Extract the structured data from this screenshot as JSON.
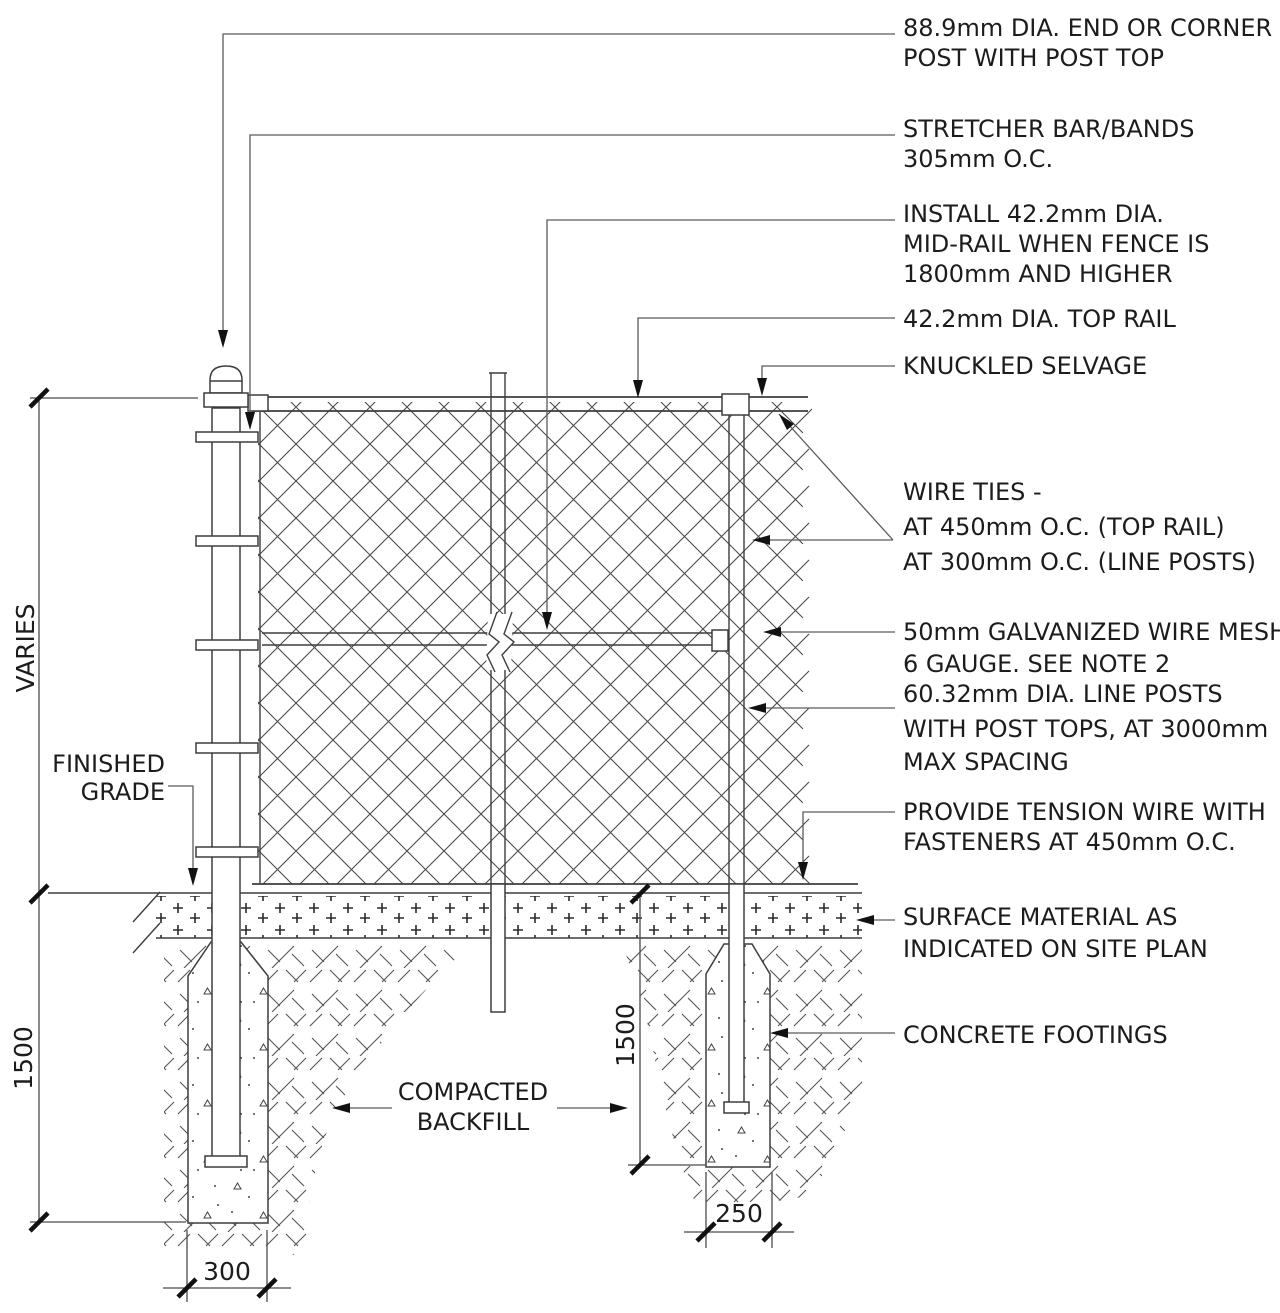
{
  "drawing": {
    "type": "construction-detail",
    "subject": "chain link fence section detail",
    "background": "#ffffff",
    "line_color": "#3d3d3d",
    "text_color": "#1c1c1c"
  },
  "annotations_right": [
    {
      "id": "end-post",
      "lines": [
        "88.9mm DIA. END OR CORNER",
        "POST WITH POST TOP"
      ]
    },
    {
      "id": "stretcher-bar",
      "lines": [
        "STRETCHER BAR/BANDS",
        "305mm O.C."
      ]
    },
    {
      "id": "mid-rail",
      "lines": [
        "INSTALL 42.2mm DIA.",
        "MID-RAIL WHEN FENCE IS",
        "1800mm AND HIGHER"
      ]
    },
    {
      "id": "top-rail",
      "lines": [
        "42.2mm DIA. TOP RAIL"
      ]
    },
    {
      "id": "knuckled-selvage",
      "lines": [
        "KNUCKLED SELVAGE"
      ]
    },
    {
      "id": "wire-ties",
      "lines": [
        "WIRE TIES -",
        "AT 450mm O.C. (TOP RAIL)",
        "AT 300mm O.C. (LINE POSTS)"
      ]
    },
    {
      "id": "wire-mesh",
      "lines": [
        "50mm GALVANIZED WIRE MESH",
        "6 GAUGE. SEE NOTE 2"
      ]
    },
    {
      "id": "line-posts",
      "lines": [
        "60.32mm DIA. LINE POSTS",
        "WITH POST TOPS, AT 3000mm",
        "MAX SPACING"
      ]
    },
    {
      "id": "tension-wire",
      "lines": [
        "PROVIDE TENSION WIRE WITH",
        "FASTENERS AT 450mm O.C."
      ]
    },
    {
      "id": "surface-material",
      "lines": [
        "SURFACE MATERIAL AS",
        "INDICATED ON SITE PLAN"
      ]
    },
    {
      "id": "concrete-footings",
      "lines": [
        "CONCRETE FOOTINGS"
      ]
    }
  ],
  "annotations_left": {
    "finished_grade": {
      "lines": [
        "FINISHED",
        "GRADE"
      ]
    },
    "compacted_backfill": {
      "lines": [
        "COMPACTED",
        "BACKFILL"
      ]
    }
  },
  "dimensions": {
    "fence_height": "VARIES",
    "left_footing_depth": "1500",
    "left_footing_width": "300",
    "right_footing_depth": "1500",
    "right_footing_width": "250"
  }
}
